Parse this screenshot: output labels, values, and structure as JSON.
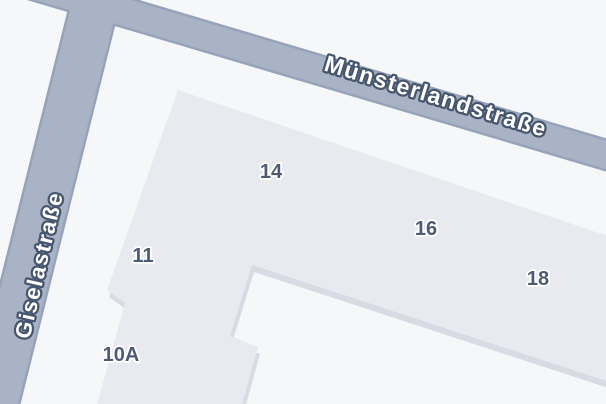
{
  "map": {
    "type": "street-map",
    "streets": [
      {
        "name": "Münsterlandstraße"
      },
      {
        "name": "Giselastraße"
      }
    ],
    "house_numbers": [
      {
        "label": "14"
      },
      {
        "label": "16"
      },
      {
        "label": "18"
      },
      {
        "label": "11"
      },
      {
        "label": "10A"
      }
    ],
    "colors": {
      "background": "#f6f7f8",
      "road_fill": "#a9b3c6",
      "road_casing": "#97a3b9",
      "building_roof": "#e8eaef",
      "building_side": "#d8dbe4",
      "street_label_fill": "#ffffff",
      "street_label_halo": "#47566f",
      "house_number_color": "#4d5c74"
    }
  }
}
